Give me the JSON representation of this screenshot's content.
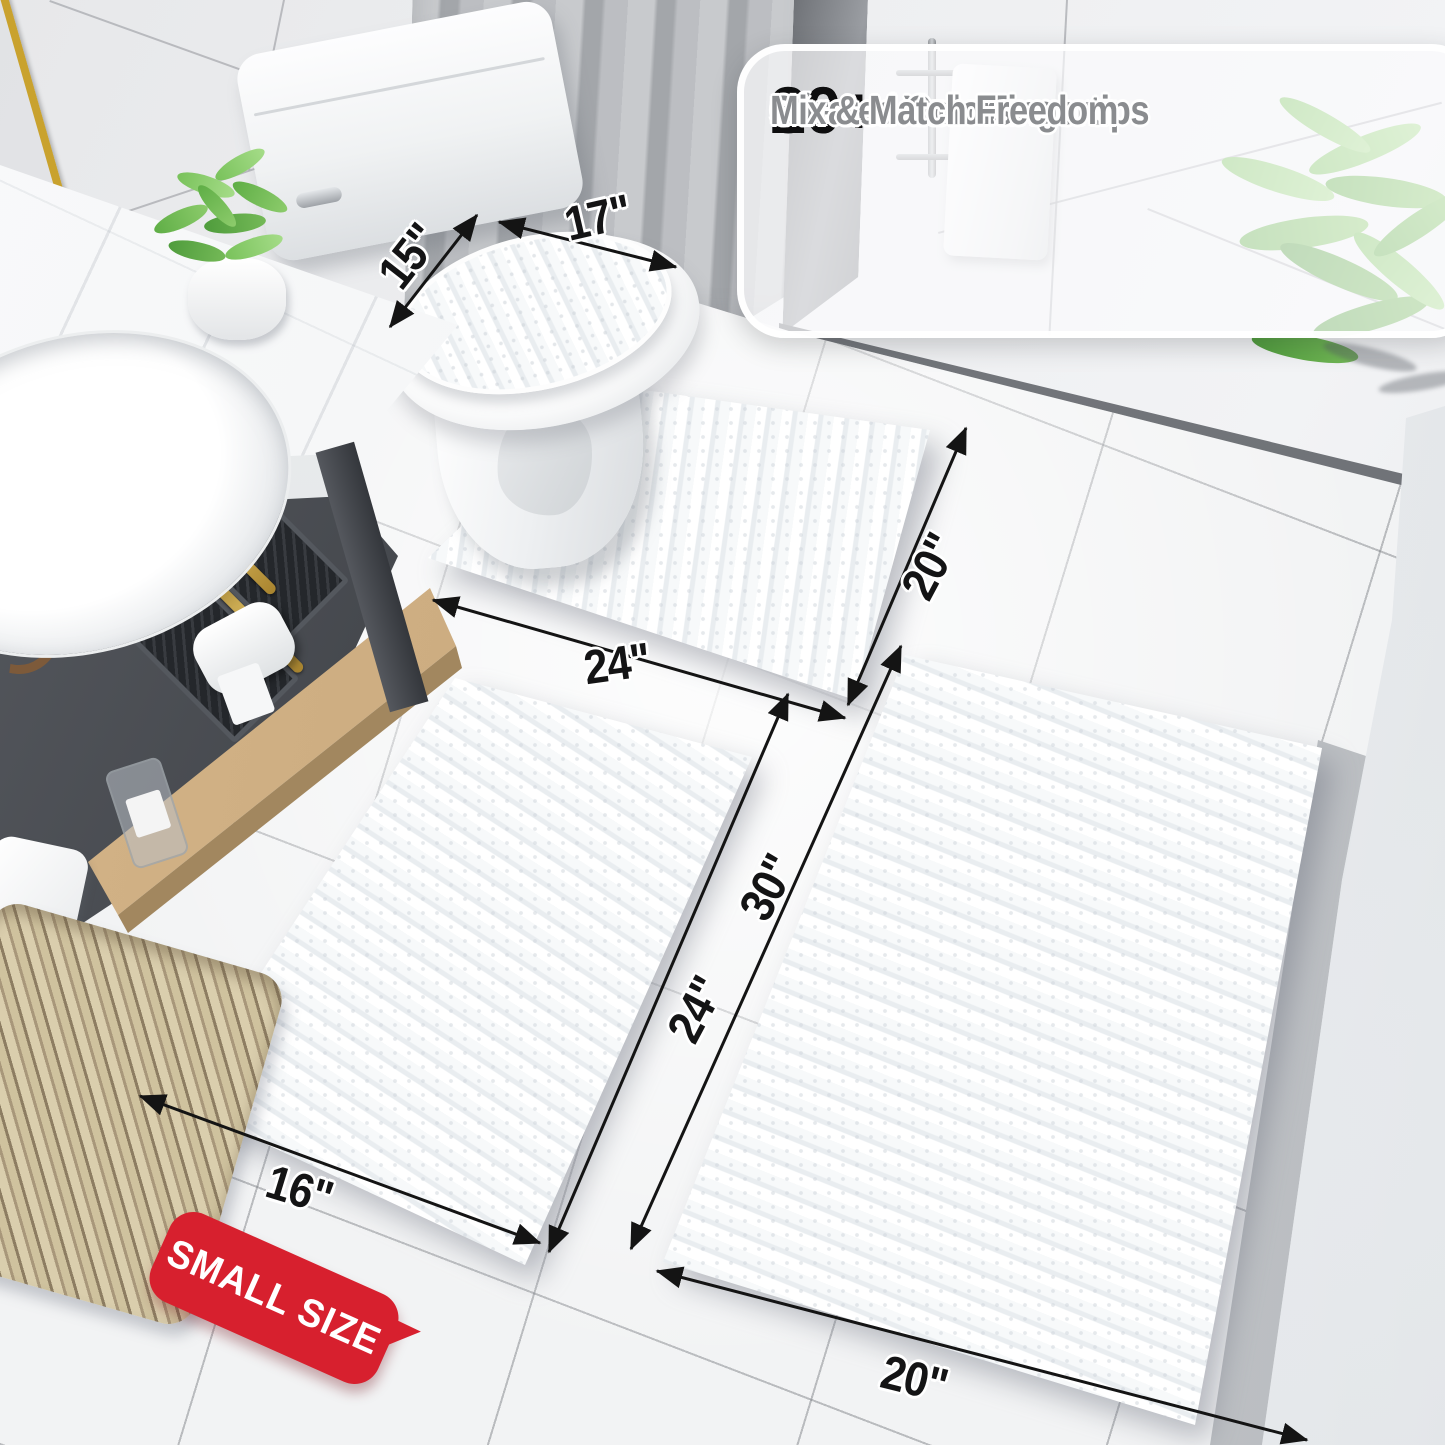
{
  "annotations": {
    "checkmark": "✓",
    "features": [
      {
        "badge": "20+",
        "label": "Sizes at Your Fingertips"
      },
      {
        "badge": "30+",
        "label": "Curated Colors"
      },
      {
        "badge": "",
        "label": "Mix & Match Freedom"
      }
    ],
    "dimensions": {
      "lid_depth": "15\"",
      "lid_width": "17\"",
      "contour_width": "24\"",
      "contour_depth": "20\"",
      "large_rug_length": "30\"",
      "small_rug_length": "24\"",
      "small_rug_width": "16\"",
      "large_rug_width": "20\""
    },
    "size_badge": "SMALL SIZE"
  },
  "colors": {
    "badge_red": "#d7202e",
    "dimension_text_black": "#141415",
    "feature_text_gray": "#8a8c8f",
    "checkmark_gray": "#8e9194",
    "number_black": "#0e0e0f",
    "accent_gold": "#c9a22e",
    "plant_green": "#79c25b",
    "rug_white": "#ffffff"
  }
}
